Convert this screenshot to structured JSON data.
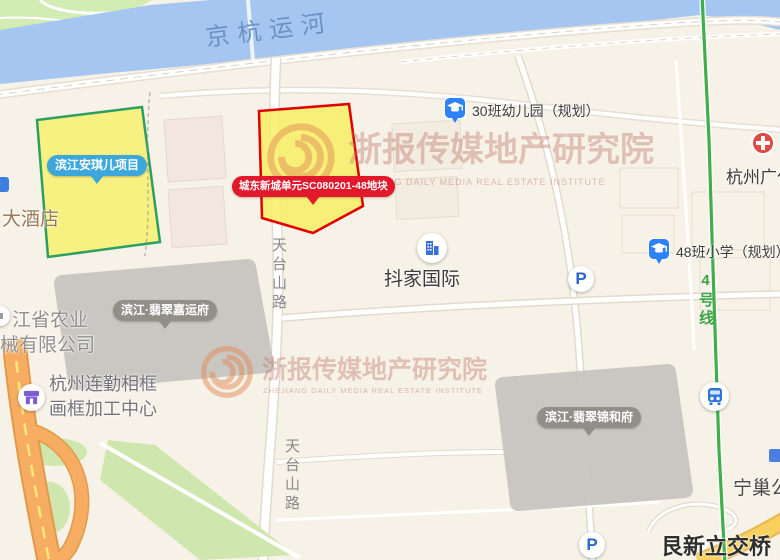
{
  "river": {
    "label": "京杭运河"
  },
  "parcels": {
    "anqier": {
      "label": "滨江安琪儿项目",
      "bubble_color": "#3da7db",
      "fill": "#f6ef6e",
      "border": "#2f9e62"
    },
    "target": {
      "label": "城东新城单元SC080201-48地块",
      "bubble_color": "#e2182b",
      "fill": "#f6ef6e",
      "border": "#e00000"
    },
    "jiayunfu": {
      "label": "滨江·翡翠嘉运府",
      "bubble_color": "#94928d",
      "fill": "#c9c6c1"
    },
    "jinhefu": {
      "label": "滨江·翡翠锦和府",
      "bubble_color": "#94928d",
      "fill": "#c9c6c1"
    }
  },
  "pois": {
    "kindergarten": {
      "label": "30班幼儿园（规划）"
    },
    "primary_school": {
      "label": "48班小学（规划）"
    },
    "doujia": {
      "label": "抖家国际"
    },
    "hotel": {
      "label": "大酒店"
    },
    "agri_company": {
      "line1": "江省农业",
      "line2": "械有限公司"
    },
    "frame_center": {
      "line1": "杭州连勤相框",
      "line2": "画框加工中心"
    },
    "hospital": {
      "label": "杭州广仁"
    },
    "ningchao": {
      "label": "宁巢公"
    },
    "interchange": {
      "label": "艮新立交桥"
    },
    "parking_letter": "P"
  },
  "roads": {
    "tiantaishan": "天台山路",
    "metro_line": "4号线"
  },
  "watermark": {
    "text": "浙报传媒地产研究院",
    "subtext": "ZHEJIANG DAILY MEDIA REAL ESTATE INSTITUTE"
  },
  "colors": {
    "water": "#a5c6f0",
    "land": "#f7f2e8",
    "park_green": "#d3ecb4",
    "metro_green": "#3fae4b",
    "highway_orange": "#f6ad62",
    "watermark": "#be7666",
    "school_icon_blue": "#2e82f7",
    "hospital_red": "#e04a43",
    "shop_purple": "#7a5cd6",
    "parking_blue": "#2b66cf"
  }
}
